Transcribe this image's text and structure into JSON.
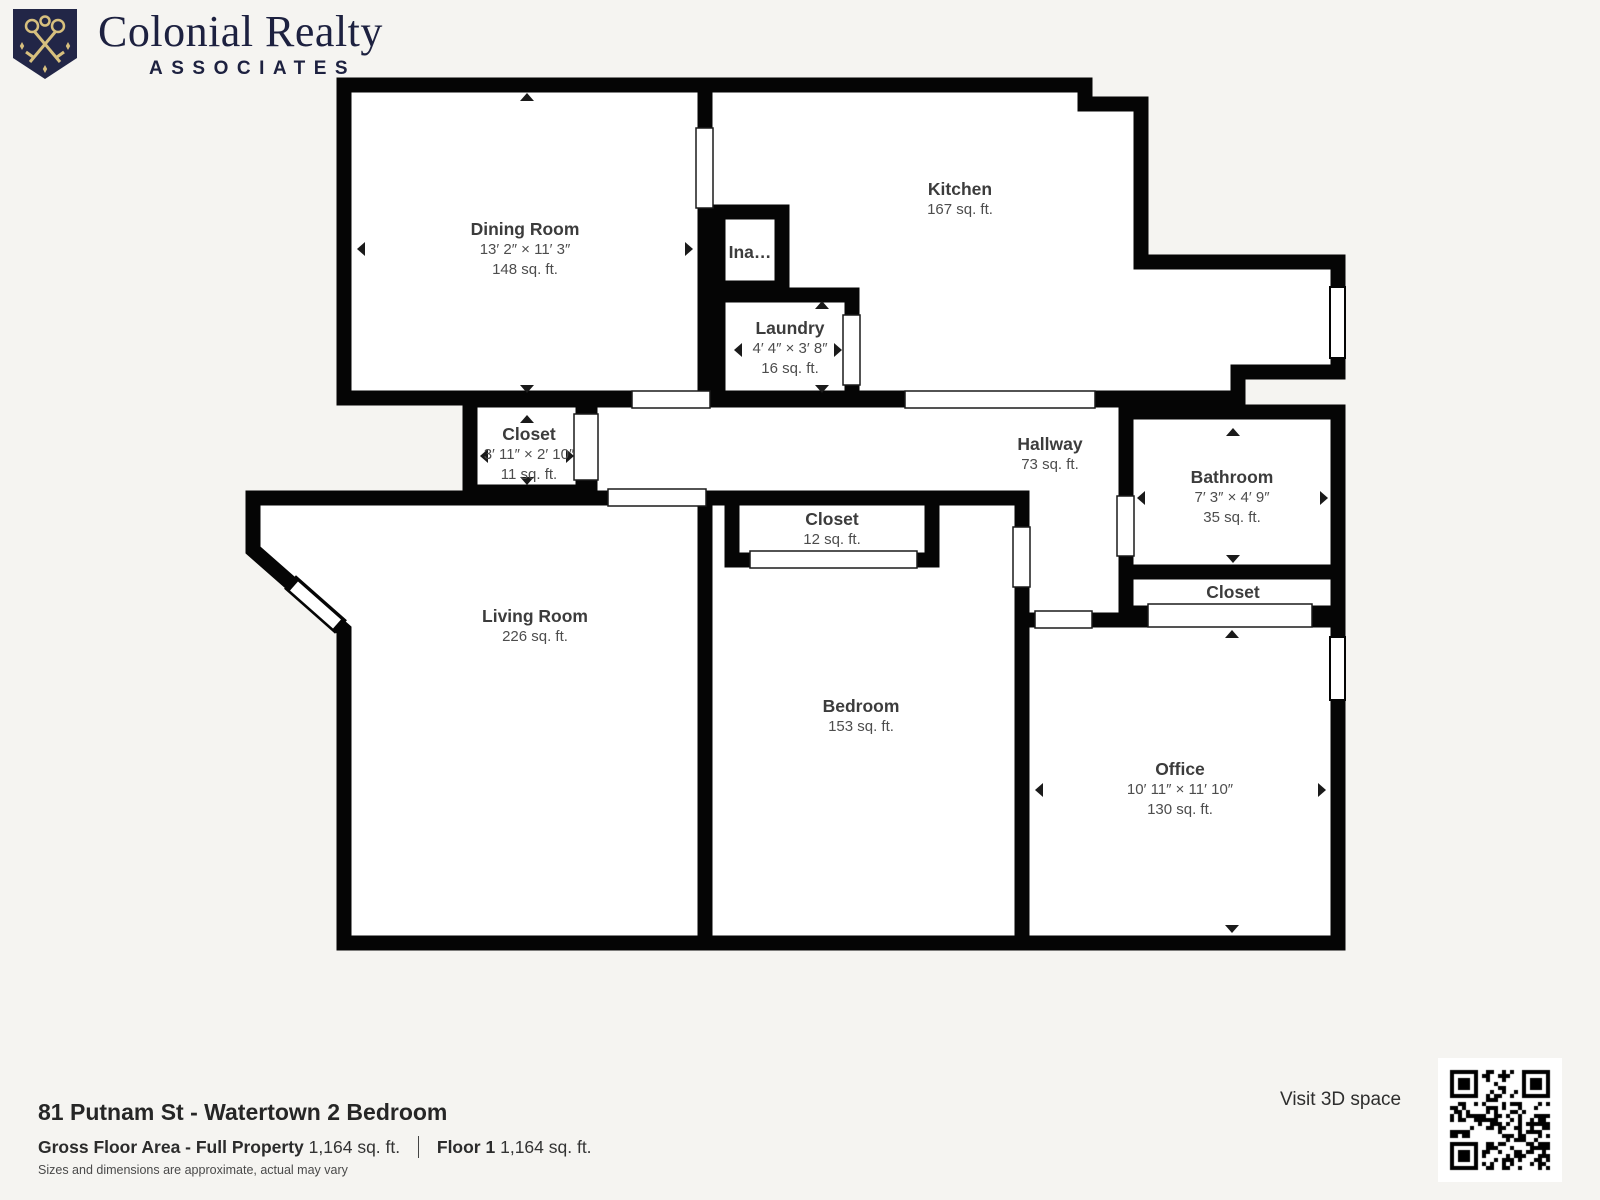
{
  "brand": {
    "name": "Colonial Realty",
    "subtitle": "ASSOCIATES"
  },
  "plan": {
    "rooms": [
      {
        "name": "Dining Room",
        "dims": "13′ 2″ × 11′ 3″",
        "area": "148 sq. ft."
      },
      {
        "name": "Kitchen",
        "area": "167 sq. ft."
      },
      {
        "name": "Ina…"
      },
      {
        "name": "Laundry",
        "dims": "4′ 4″ × 3′ 8″",
        "area": "16 sq. ft."
      },
      {
        "name": "Closet",
        "dims": "3′ 11″ × 2′ 10″",
        "area": "11 sq. ft."
      },
      {
        "name": "Hallway",
        "area": "73 sq. ft."
      },
      {
        "name": "Bathroom",
        "dims": "7′ 3″ × 4′ 9″",
        "area": "35 sq. ft."
      },
      {
        "name": "Closet",
        "area": "12 sq. ft."
      },
      {
        "name": "Living Room",
        "area": "226 sq. ft."
      },
      {
        "name": "Bedroom",
        "area": "153 sq. ft."
      },
      {
        "name": "Closet"
      },
      {
        "name": "Office",
        "dims": "10′ 11″ × 11′ 10″",
        "area": "130 sq. ft."
      }
    ]
  },
  "footer": {
    "title": "81 Putnam St - Watertown 2 Bedroom",
    "gross_label": "Gross Floor Area - Full Property",
    "gross_value": "1,164 sq. ft.",
    "floor_label": "Floor 1",
    "floor_value": "1,164 sq. ft.",
    "disclaimer": "Sizes and dimensions are approximate, actual may vary",
    "visit_3d": "Visit 3D space"
  },
  "colors": {
    "background": "#f5f4f1",
    "wall": "#050505",
    "room_fill": "#ffffff",
    "brand_navy": "#1d2140",
    "brand_gold": "#d7bf7e",
    "label_text": "#3c3c3c"
  }
}
